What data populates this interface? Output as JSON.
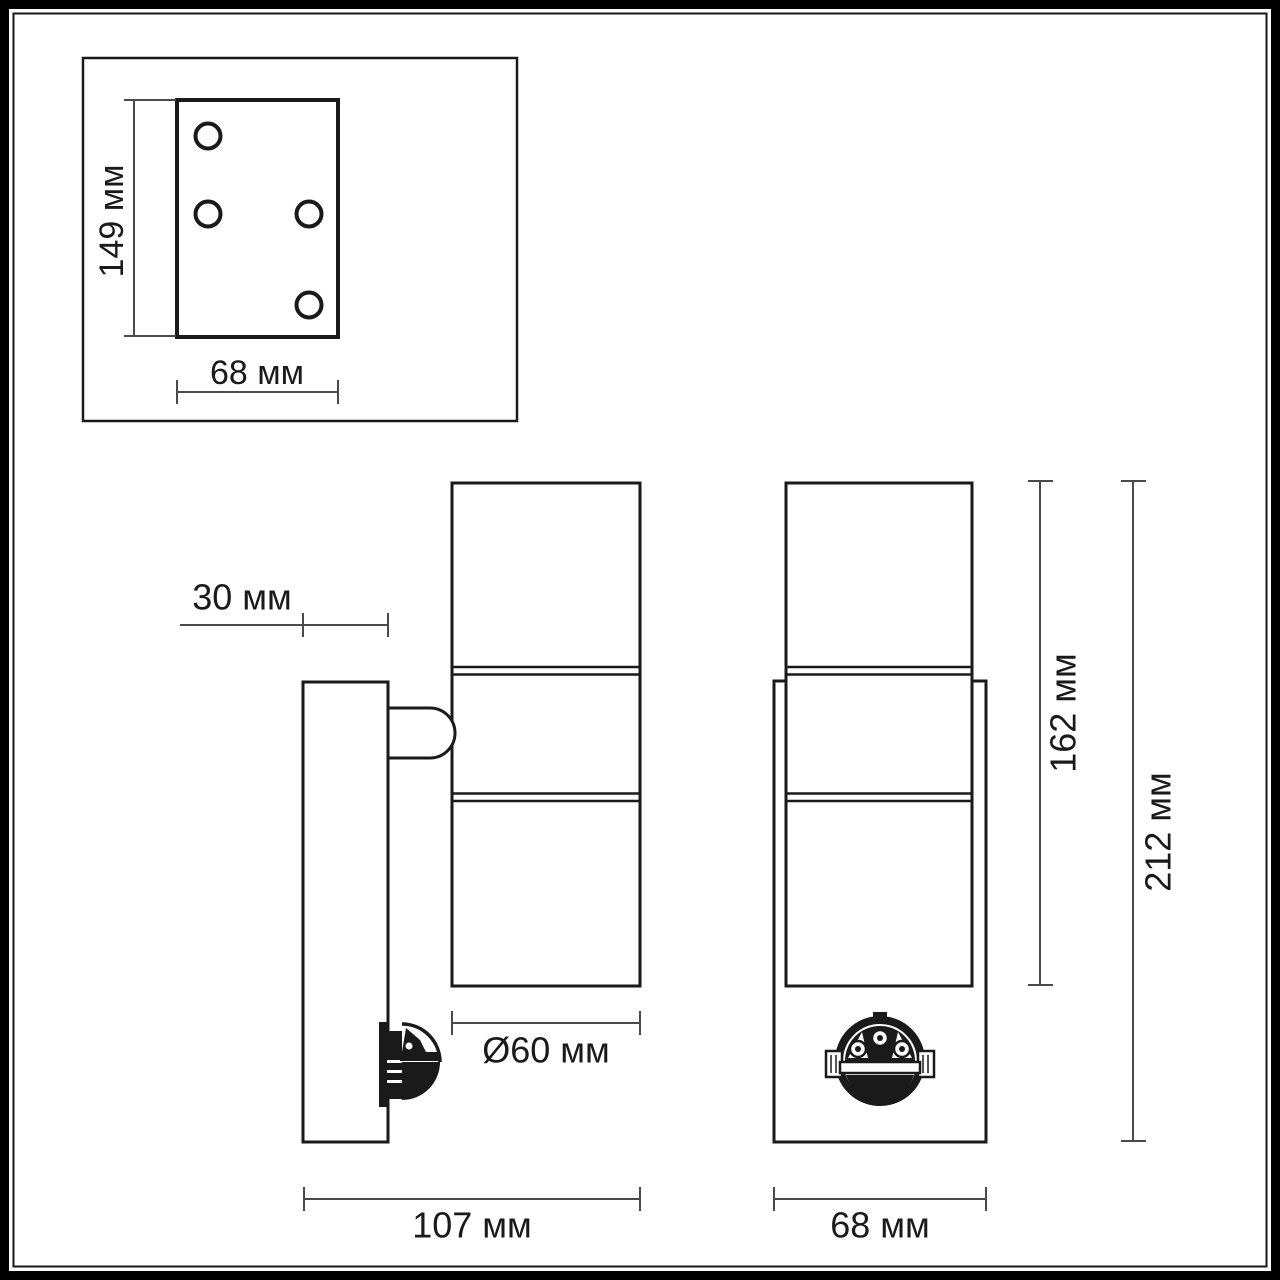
{
  "title": "wall-luminaire-technical-drawing",
  "units": "мм",
  "colors": {
    "background": "#ffffff",
    "line": "#1a1a1a",
    "dimension_line": "#4a4a4a"
  },
  "mounting_plate_inset": {
    "height_label": "149 мм",
    "width_label": "68 мм",
    "hole_count": 4
  },
  "side_view": {
    "bracket_depth_label": "30 мм",
    "diameter_label": "Ø60 мм",
    "total_depth_label": "107 мм"
  },
  "front_view": {
    "body_height_label": "162 мм",
    "total_height_label": "212 мм",
    "width_label": "68 мм"
  },
  "dimensions_mm": {
    "mounting_plate_height": 149,
    "mounting_plate_width": 68,
    "bracket_depth": 30,
    "cylinder_diameter": 60,
    "total_depth": 107,
    "body_height": 162,
    "total_height": 212,
    "front_width": 68
  }
}
